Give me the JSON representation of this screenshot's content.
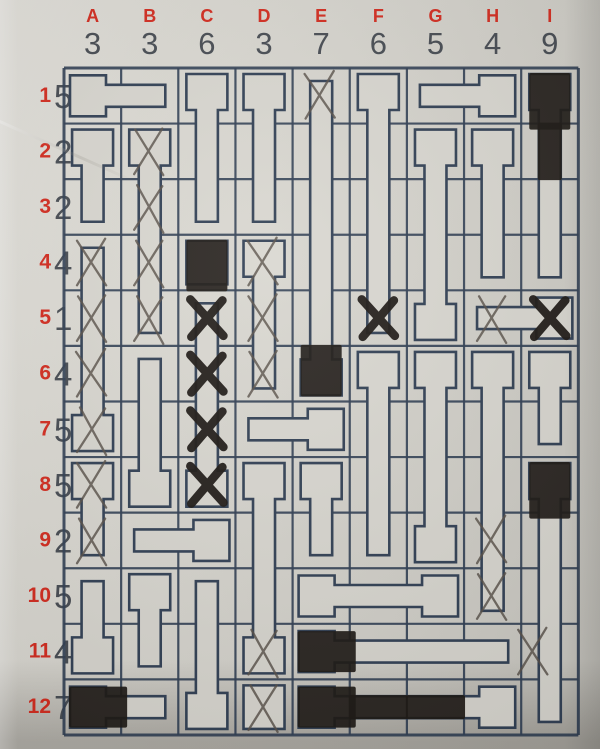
{
  "puzzle": {
    "type": "nail-placement-grid-puzzle",
    "grid_cols": 9,
    "grid_rows": 12,
    "columns": [
      {
        "label": "A",
        "clue": "3"
      },
      {
        "label": "B",
        "clue": "3"
      },
      {
        "label": "C",
        "clue": "6"
      },
      {
        "label": "D",
        "clue": "3"
      },
      {
        "label": "E",
        "clue": "7"
      },
      {
        "label": "F",
        "clue": "6"
      },
      {
        "label": "G",
        "clue": "5"
      },
      {
        "label": "H",
        "clue": "4"
      },
      {
        "label": "I",
        "clue": "9"
      }
    ],
    "rows": [
      {
        "label": "1",
        "clue": "5"
      },
      {
        "label": "2",
        "clue": "2"
      },
      {
        "label": "3",
        "clue": "2"
      },
      {
        "label": "4",
        "clue": "4"
      },
      {
        "label": "5",
        "clue": "1"
      },
      {
        "label": "6",
        "clue": "4"
      },
      {
        "label": "7",
        "clue": "5"
      },
      {
        "label": "8",
        "clue": "5"
      },
      {
        "label": "9",
        "clue": "2"
      },
      {
        "label": "10",
        "clue": "5"
      },
      {
        "label": "11",
        "clue": "4"
      },
      {
        "label": "12",
        "clue": "7"
      }
    ],
    "pieces": [
      {
        "id": "A1-B1",
        "orient": "h",
        "col": 1,
        "row": 1,
        "len": 2,
        "heads": [
          "W"
        ]
      },
      {
        "id": "C1-C3",
        "orient": "v",
        "col": 3,
        "row": 1,
        "len": 3,
        "heads": [
          "N"
        ]
      },
      {
        "id": "D1-D3",
        "orient": "v",
        "col": 4,
        "row": 1,
        "len": 3,
        "heads": [
          "N"
        ]
      },
      {
        "id": "E1-E6",
        "orient": "v",
        "col": 5,
        "row": 1,
        "len": 6,
        "heads": [
          "S"
        ]
      },
      {
        "id": "F1-F5",
        "orient": "v",
        "col": 6,
        "row": 1,
        "len": 5,
        "heads": [
          "N"
        ]
      },
      {
        "id": "G1-H1",
        "orient": "h",
        "col": 7,
        "row": 1,
        "len": 2,
        "heads": [
          "E"
        ]
      },
      {
        "id": "I1-I4",
        "orient": "v",
        "col": 9,
        "row": 1,
        "len": 4,
        "heads": [
          "N"
        ]
      },
      {
        "id": "A2-A3",
        "orient": "v",
        "col": 1,
        "row": 2,
        "len": 2,
        "heads": [
          "N"
        ]
      },
      {
        "id": "B2-B5",
        "orient": "v",
        "col": 2,
        "row": 2,
        "len": 4,
        "heads": [
          "N"
        ]
      },
      {
        "id": "G2-G5",
        "orient": "v",
        "col": 7,
        "row": 2,
        "len": 4,
        "heads": [
          "N",
          "S"
        ]
      },
      {
        "id": "H2-H4",
        "orient": "v",
        "col": 8,
        "row": 2,
        "len": 3,
        "heads": [
          "N"
        ]
      },
      {
        "id": "A4-A7",
        "orient": "v",
        "col": 1,
        "row": 4,
        "len": 4,
        "heads": [
          "S"
        ]
      },
      {
        "id": "C4",
        "orient": "v",
        "col": 3,
        "row": 4,
        "len": 1,
        "heads": [
          "N"
        ]
      },
      {
        "id": "D4-D6",
        "orient": "v",
        "col": 4,
        "row": 4,
        "len": 3,
        "heads": [
          "N"
        ]
      },
      {
        "id": "C5-C8",
        "orient": "v",
        "col": 3,
        "row": 5,
        "len": 4,
        "heads": [
          "S"
        ]
      },
      {
        "id": "H5-I5",
        "orient": "h",
        "col": 8,
        "row": 5,
        "len": 2,
        "heads": [
          "E"
        ]
      },
      {
        "id": "B6-B8",
        "orient": "v",
        "col": 2,
        "row": 6,
        "len": 3,
        "heads": [
          "S"
        ]
      },
      {
        "id": "F6-F9",
        "orient": "v",
        "col": 6,
        "row": 6,
        "len": 4,
        "heads": [
          "N"
        ]
      },
      {
        "id": "G6-G9",
        "orient": "v",
        "col": 7,
        "row": 6,
        "len": 4,
        "heads": [
          "N",
          "S"
        ]
      },
      {
        "id": "H6-H10",
        "orient": "v",
        "col": 8,
        "row": 6,
        "len": 5,
        "heads": [
          "N"
        ]
      },
      {
        "id": "I6-I7",
        "orient": "v",
        "col": 9,
        "row": 6,
        "len": 2,
        "heads": [
          "N"
        ]
      },
      {
        "id": "D7-E7",
        "orient": "h",
        "col": 4,
        "row": 7,
        "len": 2,
        "heads": [
          "E"
        ]
      },
      {
        "id": "A8-A9",
        "orient": "v",
        "col": 1,
        "row": 8,
        "len": 2,
        "heads": [
          "N"
        ]
      },
      {
        "id": "D8-D11",
        "orient": "v",
        "col": 4,
        "row": 8,
        "len": 4,
        "heads": [
          "N",
          "S"
        ]
      },
      {
        "id": "E8-E9",
        "orient": "v",
        "col": 5,
        "row": 8,
        "len": 2,
        "heads": [
          "N"
        ]
      },
      {
        "id": "I8-I12",
        "orient": "v",
        "col": 9,
        "row": 8,
        "len": 5,
        "heads": [
          "N"
        ]
      },
      {
        "id": "B9-C9",
        "orient": "h",
        "col": 2,
        "row": 9,
        "len": 2,
        "heads": [
          "E"
        ]
      },
      {
        "id": "A10-A11",
        "orient": "v",
        "col": 1,
        "row": 10,
        "len": 2,
        "heads": [
          "S"
        ]
      },
      {
        "id": "B10-B11",
        "orient": "v",
        "col": 2,
        "row": 10,
        "len": 2,
        "heads": [
          "N"
        ]
      },
      {
        "id": "C10-C12",
        "orient": "v",
        "col": 3,
        "row": 10,
        "len": 3,
        "heads": [
          "S"
        ]
      },
      {
        "id": "E10-G10",
        "orient": "h",
        "col": 5,
        "row": 10,
        "len": 3,
        "heads": [
          "W",
          "E"
        ]
      },
      {
        "id": "E11-H11",
        "orient": "h",
        "col": 5,
        "row": 11,
        "len": 4,
        "heads": [
          "W"
        ]
      },
      {
        "id": "A12-B12",
        "orient": "h",
        "col": 1,
        "row": 12,
        "len": 2,
        "heads": [
          "W"
        ]
      },
      {
        "id": "D12",
        "orient": "v",
        "col": 4,
        "row": 12,
        "len": 1,
        "heads": [
          "N"
        ]
      },
      {
        "id": "E12-H12",
        "orient": "h",
        "col": 5,
        "row": 12,
        "len": 4,
        "heads": [
          "W",
          "E"
        ]
      }
    ],
    "marks": {
      "pencil_x_cells": [
        "E1",
        "B2",
        "B3",
        "A4",
        "B4",
        "D4",
        "A5",
        "B5",
        "D5",
        "H5",
        "A6",
        "D6",
        "A7",
        "A8",
        "A9",
        "H9",
        "H10",
        "D11",
        "I11",
        "D12"
      ],
      "marker_x_cells": [
        "C5",
        "F5",
        "I5",
        "C6",
        "C7",
        "C8"
      ],
      "marker_filled_cells": [
        "I1",
        "I2",
        "C4",
        "E6",
        "I8",
        "E11",
        "A12",
        "E12",
        "F12",
        "G12"
      ]
    },
    "colors": {
      "paper": "#d8d6cf",
      "print_line": "#2c3b50",
      "label_red": "#d32619",
      "clue_dark": "#42474e",
      "pencil": "#544c44",
      "marker": "#17120e"
    }
  }
}
